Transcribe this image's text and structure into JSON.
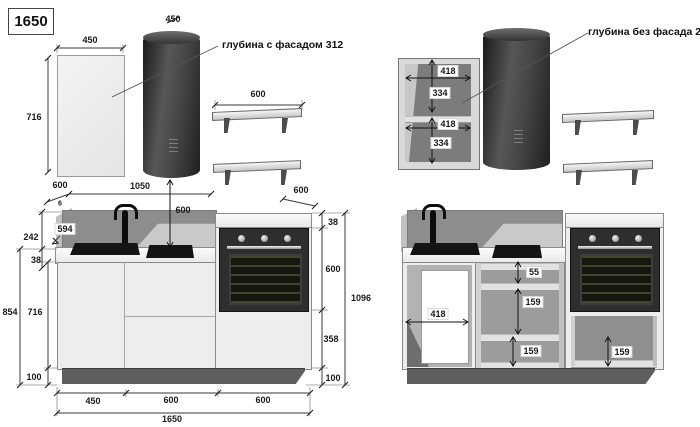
{
  "title": "1650",
  "annotations": {
    "with_facade": "глубина с фасадом 312",
    "without_facade": "глубина без фасада 296"
  },
  "dims": {
    "door_width": "450",
    "hood_width": "450",
    "door_height": "716",
    "shelf_width": "600",
    "shelf_depth": "600",
    "counter_depth": "600",
    "hood_span": "1050",
    "hob_drop": "600",
    "gap": "6",
    "worktop_depth": "594",
    "backsplash_h": "242",
    "worktop_t": "38",
    "left_total": "854",
    "cabinet_h": "716",
    "plinth_l": "100",
    "oven_top": "38",
    "oven_h": "600",
    "drawer_h": "358",
    "plinth_r": "100",
    "total_h": "1096",
    "w1": "450",
    "w2": "600",
    "w3": "600",
    "total_w": "1650",
    "wc_w1": "418",
    "wc_h1": "334",
    "wc_w2": "418",
    "wc_h2": "334",
    "sink_inner_w": "418",
    "top_gap": "55",
    "box1": "159",
    "box2": "159",
    "oven_box": "159"
  }
}
